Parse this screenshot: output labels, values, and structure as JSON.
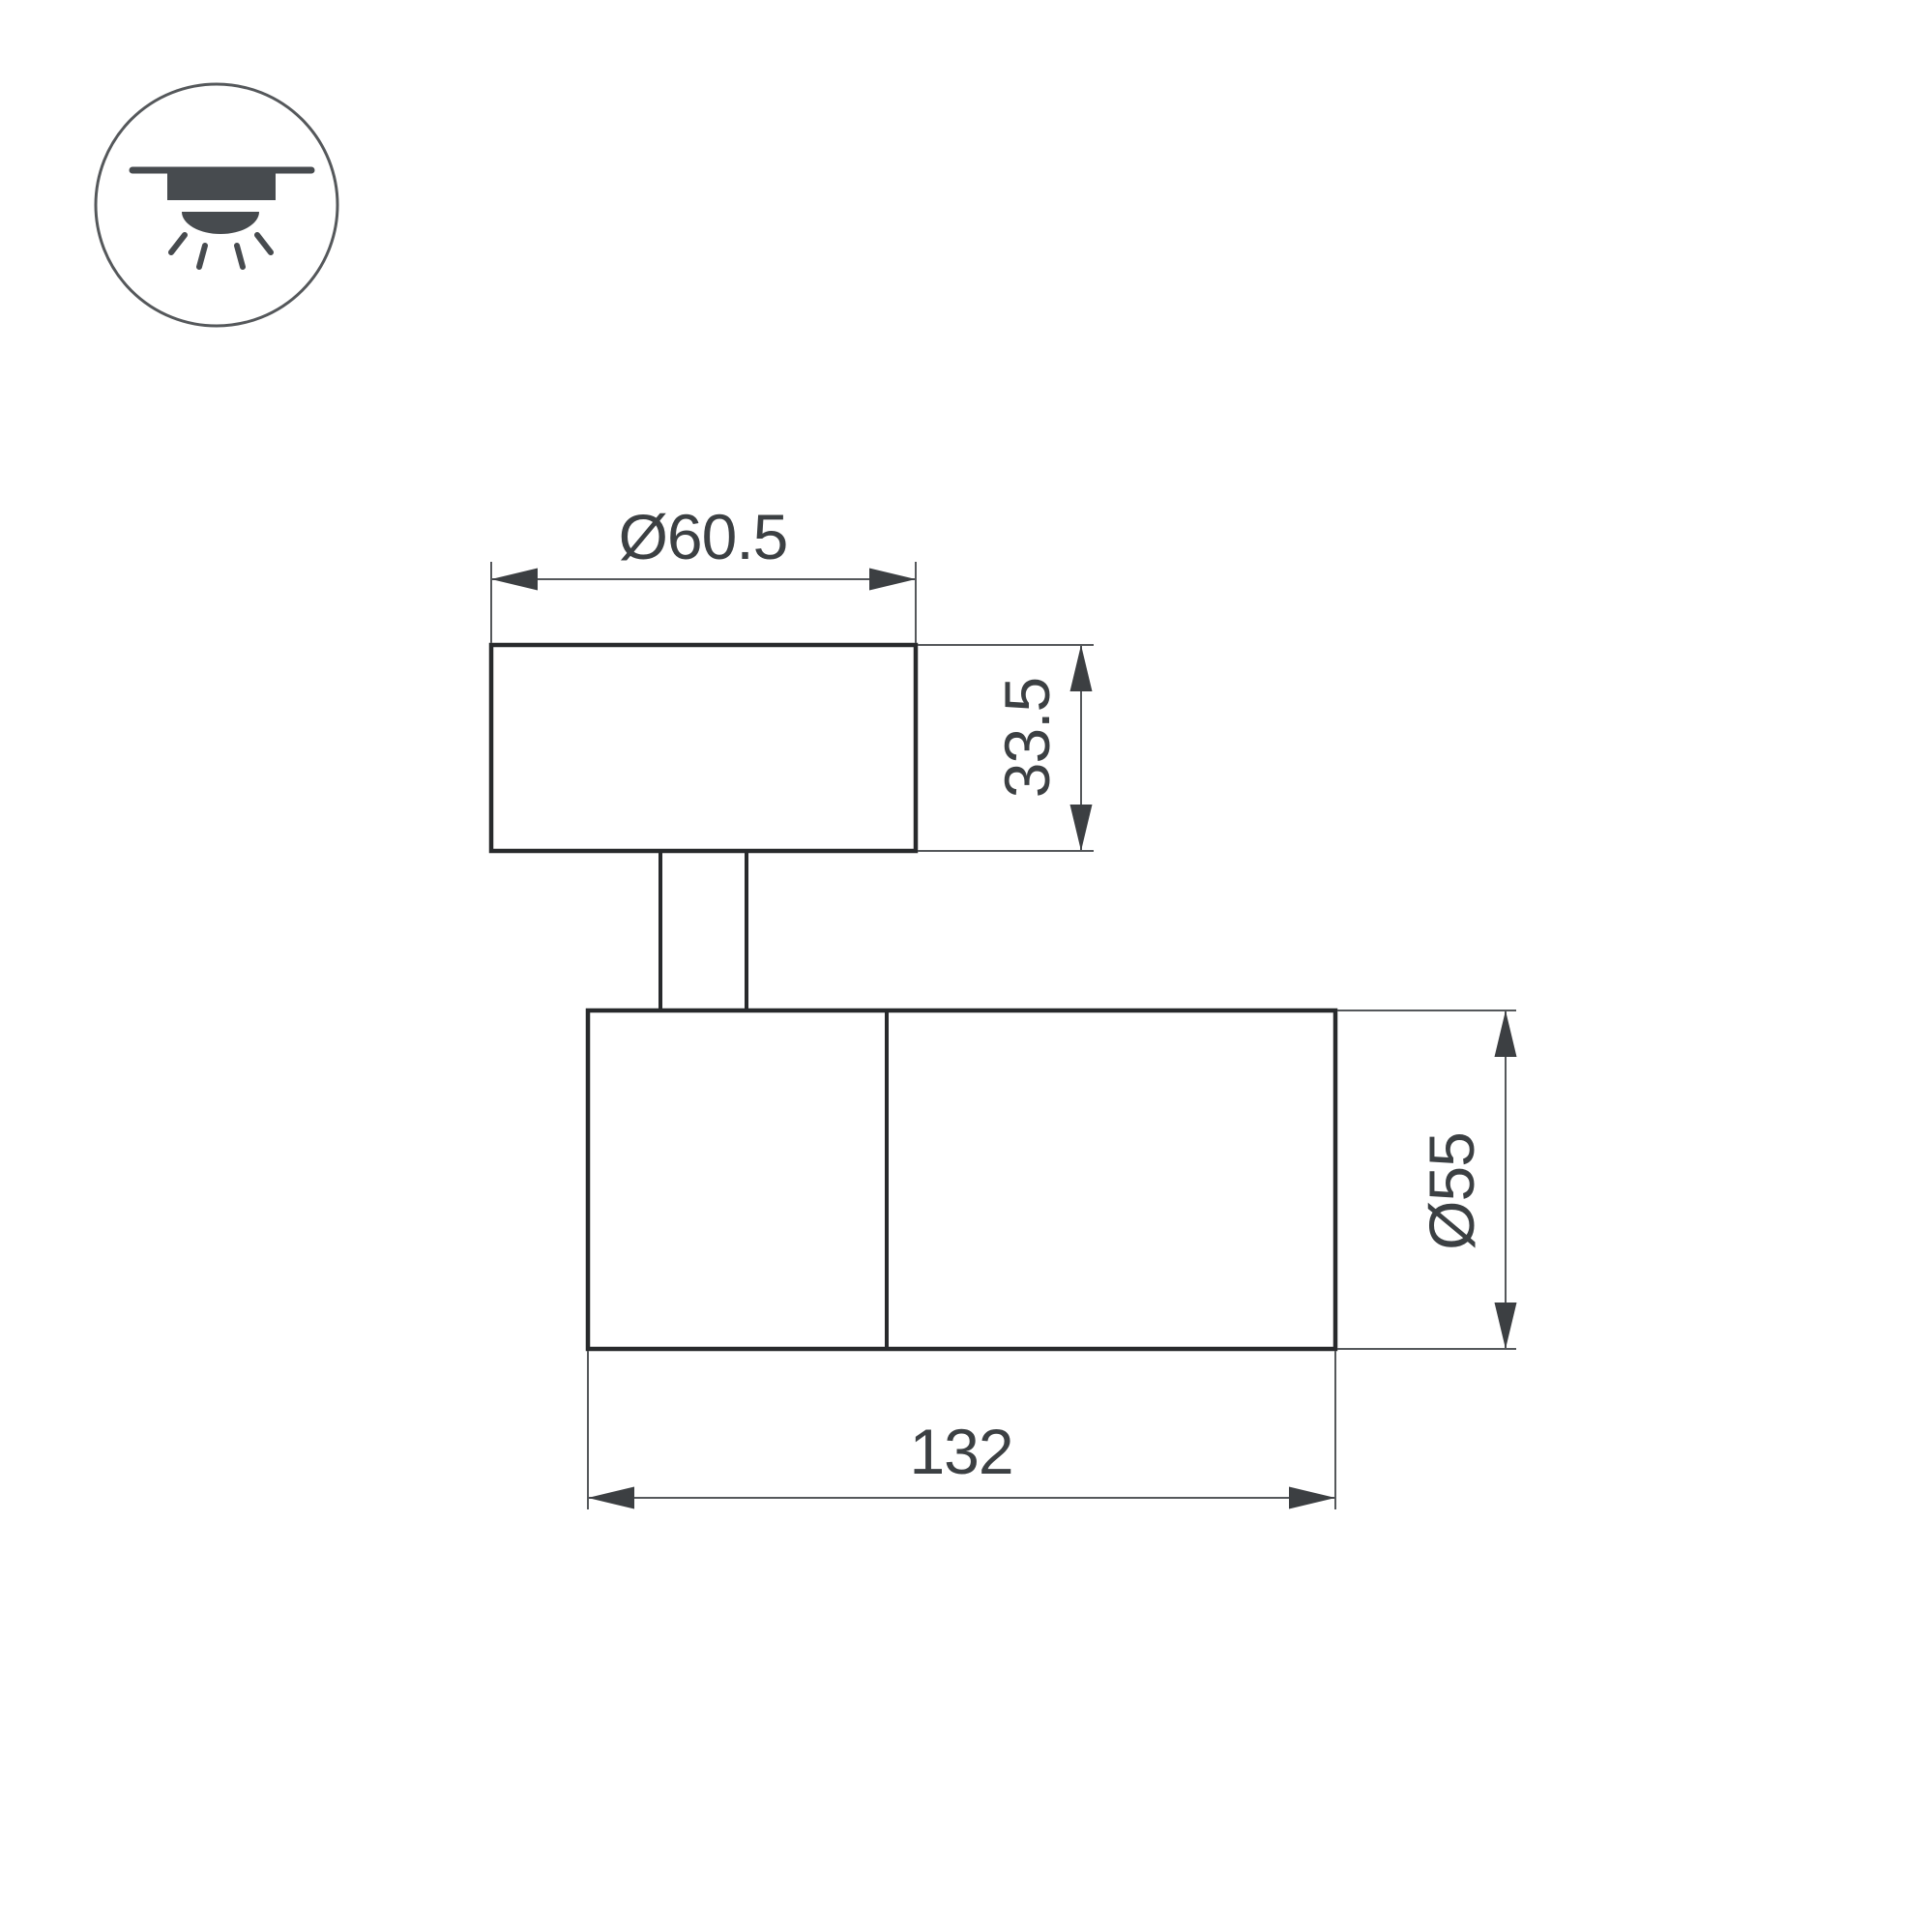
{
  "drawing": {
    "icon": {
      "name": "surface-ceiling-downlight-icon"
    },
    "dimensions": {
      "base_diameter": "Ø60.5",
      "base_height": "33.5",
      "body_diameter": "Ø55",
      "body_length": "132"
    },
    "colors": {
      "outline": "#282a2c",
      "dimension_line": "#55585b",
      "arrow_fill": "#3c3f42",
      "text": "#3c4043",
      "icon": "#474b4f",
      "background": "#ffffff"
    }
  }
}
